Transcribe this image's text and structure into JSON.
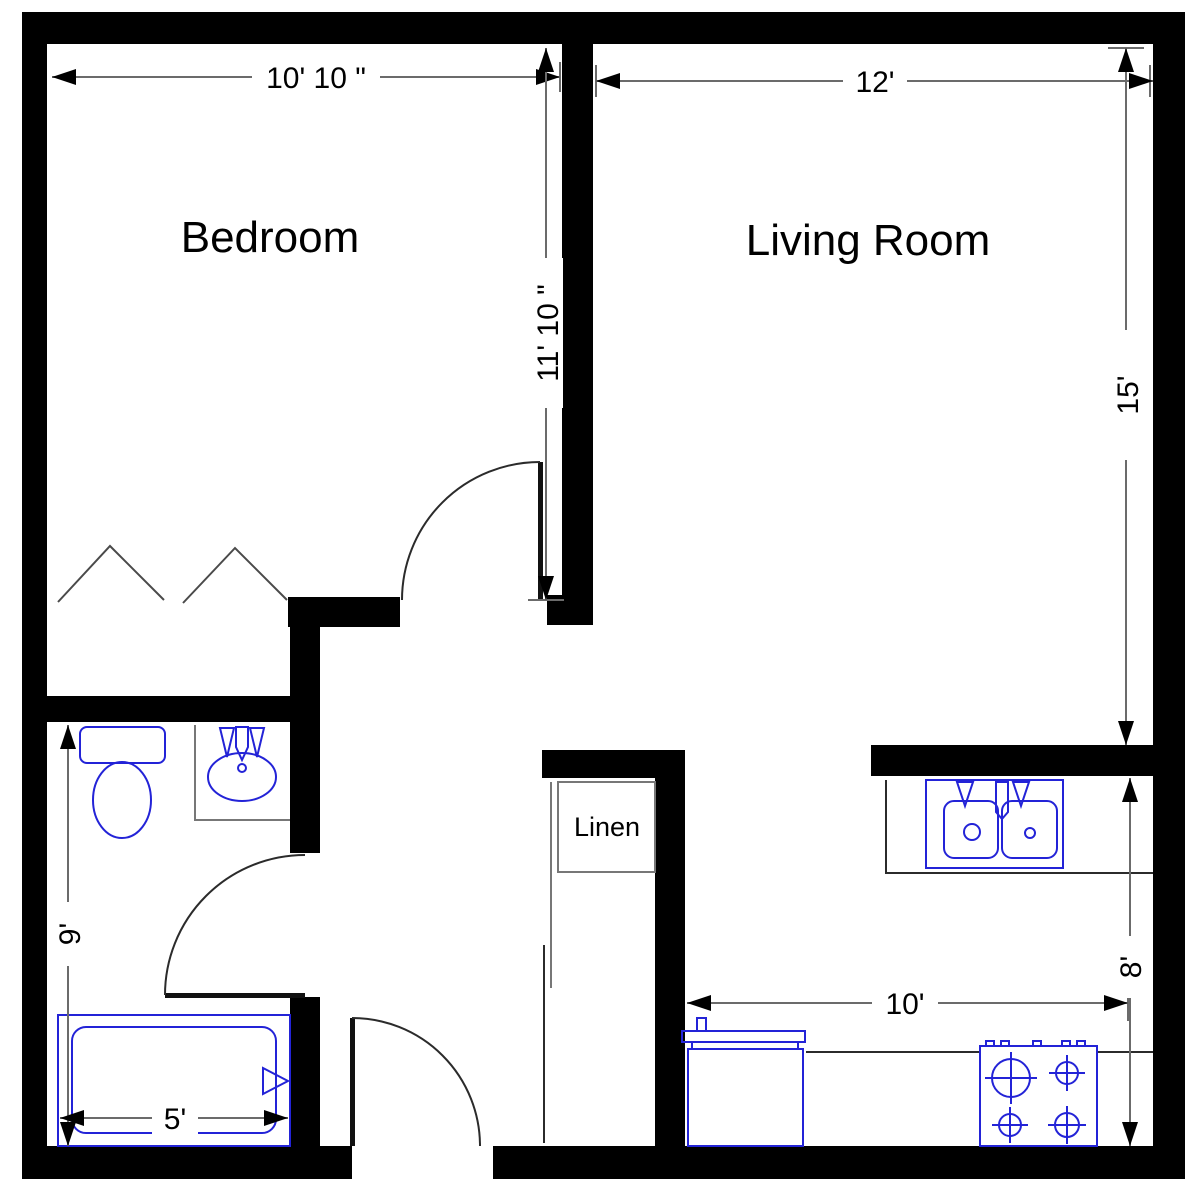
{
  "plan": {
    "rooms": {
      "bedroom": {
        "label": "Bedroom",
        "width": "10' 10 \"",
        "height": "11' 10 \""
      },
      "living_room": {
        "label": "Living Room",
        "width": "12'",
        "height": "15'"
      },
      "bathroom": {
        "height": "9'",
        "tub_width": "5'"
      },
      "kitchen": {
        "width": "10'",
        "height": "8'"
      },
      "linen_closet": {
        "label": "Linen"
      }
    },
    "fixtures": {
      "bathroom": [
        "toilet",
        "sink-basin",
        "bathtub"
      ],
      "kitchen": [
        "double-sink",
        "refrigerator",
        "stove"
      ]
    },
    "colors": {
      "wall": "#000000",
      "fixture_outline": "#2323d7",
      "dimension_line": "#6b6b6b",
      "arrow": "#000000",
      "text": "#000000",
      "background": "#ffffff"
    }
  }
}
